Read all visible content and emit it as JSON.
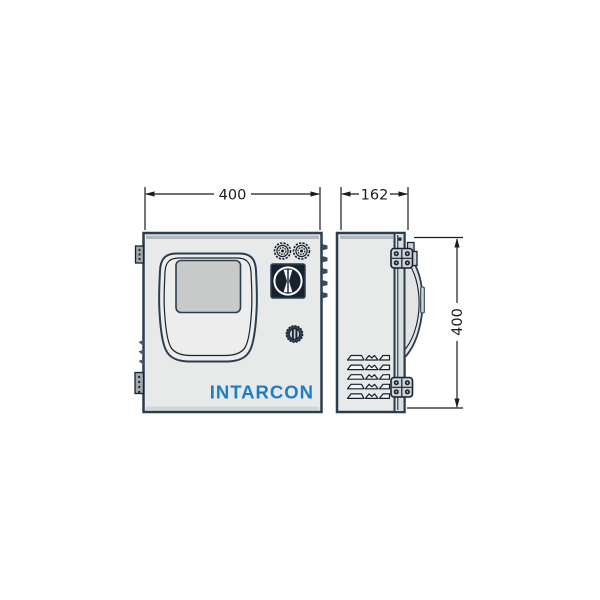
{
  "dimensions": {
    "front_width_mm": "400",
    "side_depth_mm": "162",
    "side_height_mm": "400"
  },
  "brand": {
    "logo_text": "INTARCON",
    "logo_color": "#1b7ec5"
  },
  "colors": {
    "background": "#ffffff",
    "outline": "#2b3e50",
    "dimension": "#1c1c1c",
    "enclosure_fill": "#e8e9e9",
    "cover_fill": "#ededee",
    "screen_fill": "#c8c9c9",
    "hinge_fill": "#ccd2d5",
    "dark_part": "#16222e"
  },
  "parts": {
    "front_view": "front view of enclosure",
    "side_view": "side view of enclosure",
    "display_window": "display window",
    "cable_glands": "2 knurled cable glands",
    "rotary_switch": "rotary disconnect switch",
    "door_lock": "door lock",
    "hinges": "door hinges",
    "ventilation": "ventilation louvers"
  }
}
